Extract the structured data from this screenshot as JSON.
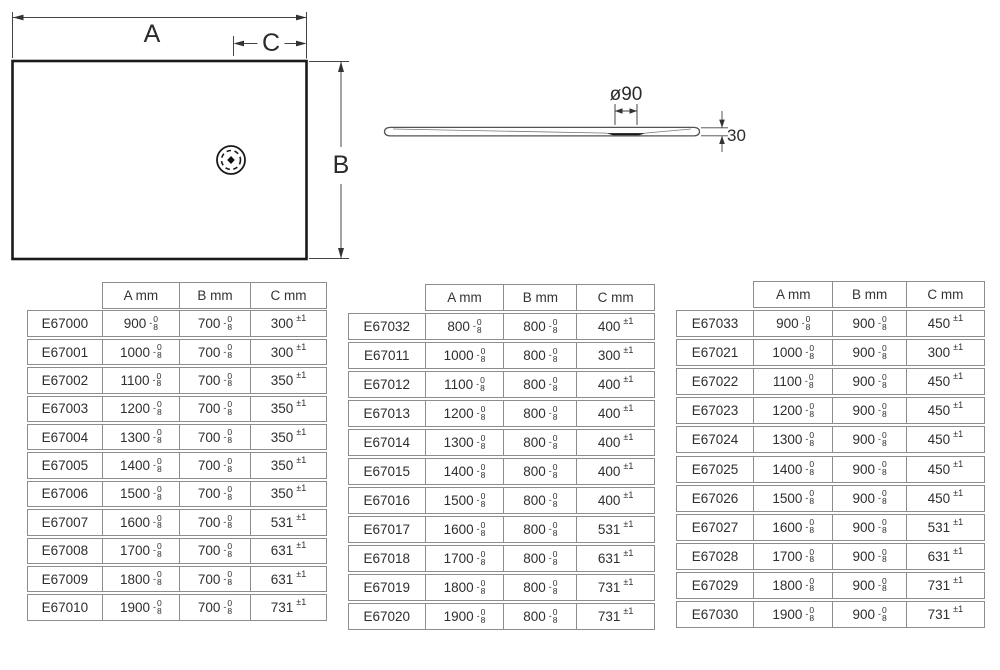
{
  "plan_view": {
    "label_a": "A",
    "label_b": "B",
    "label_c": "C"
  },
  "profile_view": {
    "diameter_label": "ø90",
    "thickness_label": "30"
  },
  "tables": [
    {
      "name": "depth-700-series",
      "col_headers": [
        "A mm",
        "B mm",
        "C mm"
      ],
      "tol_ab": {
        "sign": "-",
        "upper": "0",
        "lower": "8"
      },
      "tol_c": "±1",
      "rows": [
        [
          "E67000",
          "900",
          "700",
          "300"
        ],
        [
          "E67001",
          "1000",
          "700",
          "300"
        ],
        [
          "E67002",
          "1100",
          "700",
          "350"
        ],
        [
          "E67003",
          "1200",
          "700",
          "350"
        ],
        [
          "E67004",
          "1300",
          "700",
          "350"
        ],
        [
          "E67005",
          "1400",
          "700",
          "350"
        ],
        [
          "E67006",
          "1500",
          "700",
          "350"
        ],
        [
          "E67007",
          "1600",
          "700",
          "531"
        ],
        [
          "E67008",
          "1700",
          "700",
          "631"
        ],
        [
          "E67009",
          "1800",
          "700",
          "631"
        ],
        [
          "E67010",
          "1900",
          "700",
          "731"
        ]
      ]
    },
    {
      "name": "depth-800-series",
      "col_headers": [
        "A mm",
        "B mm",
        "C mm"
      ],
      "tol_ab": {
        "sign": "-",
        "upper": "0",
        "lower": "8"
      },
      "tol_c": "±1",
      "rows": [
        [
          "E67032",
          "800",
          "800",
          "400"
        ],
        [
          "E67011",
          "1000",
          "800",
          "300"
        ],
        [
          "E67012",
          "1100",
          "800",
          "400"
        ],
        [
          "E67013",
          "1200",
          "800",
          "400"
        ],
        [
          "E67014",
          "1300",
          "800",
          "400"
        ],
        [
          "E67015",
          "1400",
          "800",
          "400"
        ],
        [
          "E67016",
          "1500",
          "800",
          "400"
        ],
        [
          "E67017",
          "1600",
          "800",
          "531"
        ],
        [
          "E67018",
          "1700",
          "800",
          "631"
        ],
        [
          "E67019",
          "1800",
          "800",
          "731"
        ],
        [
          "E67020",
          "1900",
          "800",
          "731"
        ]
      ]
    },
    {
      "name": "depth-900-series",
      "col_headers": [
        "A mm",
        "B mm",
        "C mm"
      ],
      "tol_ab": {
        "sign": "-",
        "upper": "0",
        "lower": "8"
      },
      "tol_c": "±1",
      "rows": [
        [
          "E67033",
          "900",
          "900",
          "450"
        ],
        [
          "E67021",
          "1000",
          "900",
          "300"
        ],
        [
          "E67022",
          "1100",
          "900",
          "450"
        ],
        [
          "E67023",
          "1200",
          "900",
          "450"
        ],
        [
          "E67024",
          "1300",
          "900",
          "450"
        ],
        [
          "E67025",
          "1400",
          "900",
          "450"
        ],
        [
          "E67026",
          "1500",
          "900",
          "450"
        ],
        [
          "E67027",
          "1600",
          "900",
          "531"
        ],
        [
          "E67028",
          "1700",
          "900",
          "631"
        ],
        [
          "E67029",
          "1800",
          "900",
          "731"
        ],
        [
          "E67030",
          "1900",
          "900",
          "731"
        ]
      ]
    }
  ]
}
